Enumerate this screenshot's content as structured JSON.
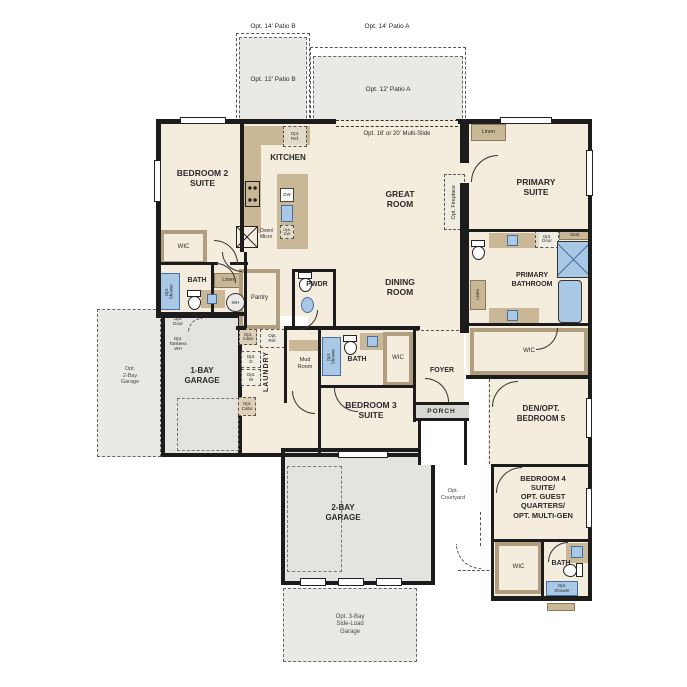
{
  "colors": {
    "wall": "#1c1c1c",
    "room_fill": "#f4ecdd",
    "cabinet_tan": "#c9b796",
    "garage_gray": "#e4e3e0",
    "optional_fill": "#eae9e5",
    "plumbing_blue": "#a9c8e6",
    "plumbing_border": "#44719f"
  },
  "patios": {
    "p14b": "Opt. 14' Patio B",
    "p14a": "Opt. 14' Patio A",
    "p12b": "Opt. 12' Patio B",
    "p12a": "Opt. 12' Patio A"
  },
  "rooms": {
    "bedroom2": "BEDROOM 2\nSUITE",
    "kitchen": "KITCHEN",
    "great": "GREAT\nROOM",
    "dining": "DINING\nROOM",
    "primary": "PRIMARY\nSUITE",
    "primary_bath": "PRIMARY\nBATHROOM",
    "bedroom3": "BEDROOM 3\nSUITE",
    "bedroom4": "BEDROOM 4\nSUITE/\nOPT. GUEST\nQUARTERS/\nOPT. MULTI-GEN",
    "den": "DEN/OPT.\nBEDROOM 5",
    "foyer": "FOYER",
    "porch": "PORCH",
    "laundry": "LAUNDRY",
    "mud": "Mud\nRoom",
    "pantry": "Pantry",
    "pwdr": "PWDR",
    "garage1": "1-BAY\nGARAGE",
    "garage2": "2-BAY\nGARAGE"
  },
  "options": {
    "multi_slide": "Opt. 16' or 20' Multi-Slide",
    "fireplace": "Opt. Fireplace",
    "ref_kitchen": "Opt.\nRef.",
    "dw": "DW",
    "opt_dw": "Opt.\nDW",
    "oven_micro": "Oven/\nMicro",
    "door": "Opt.\nDoor",
    "tankless": "Opt.\nTankless\nWH",
    "cabs": "Opt.\nCabs",
    "ref_laundry": "Opt.\nRef.",
    "dryer": "Opt.\nD",
    "washer": "Opt.\nW",
    "shower": "Opt.\nShower",
    "garage2bay": "Opt.\n2-Bay\nGarage",
    "garage3bay": "Opt. 3-Bay\nSide-Load\nGarage",
    "courtyard": "Opt.\nCourtyard"
  },
  "fixtures": {
    "wic": "WIC",
    "bath": "BATH",
    "linen": "Linen",
    "seat": "Seat",
    "wh": "WH"
  }
}
